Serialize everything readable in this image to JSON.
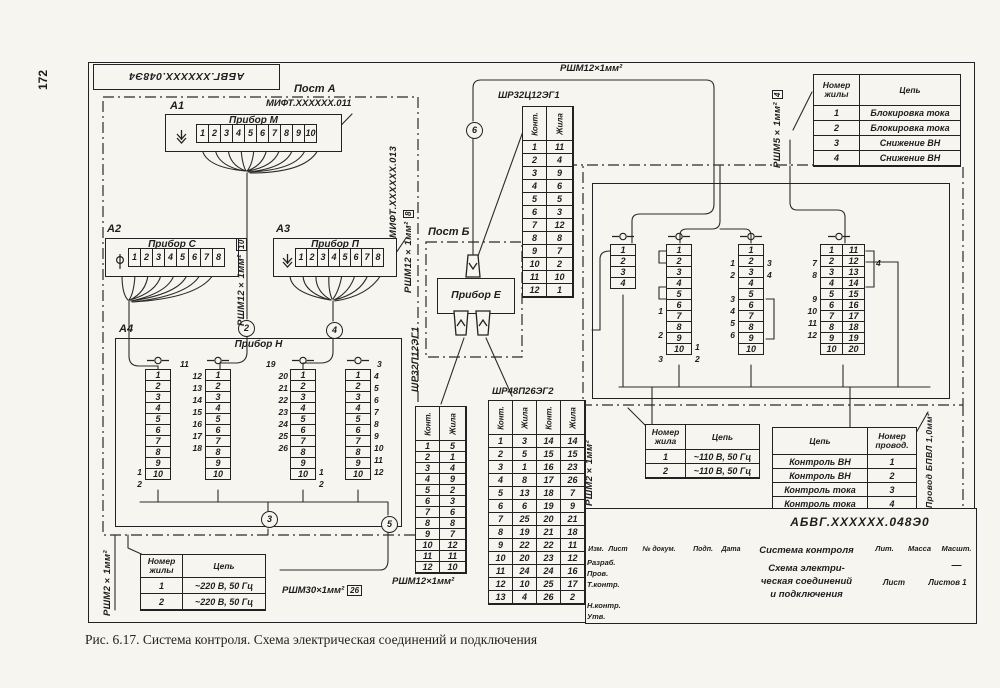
{
  "page": {
    "number": "172",
    "caption": "Рис. 6.17. Система контроля. Схема электрическая соединений и подключения"
  },
  "corner_stamp": "АБВГ.ХХХХХХ.048Э4",
  "posts": {
    "a": "Пост А",
    "b": "Пост Б"
  },
  "devices": {
    "a1": {
      "ref": "А1",
      "title": "Прибор М",
      "doc": "МИФТ.ХХХХХХ.011",
      "terminals": [
        "1",
        "2",
        "3",
        "4",
        "5",
        "6",
        "7",
        "8",
        "9",
        "10"
      ]
    },
    "a2": {
      "ref": "А2",
      "title": "Прибор С",
      "terminals": [
        "1",
        "2",
        "3",
        "4",
        "5",
        "6",
        "7",
        "8"
      ]
    },
    "a3": {
      "ref": "А3",
      "title": "Прибор П",
      "terminals": [
        "1",
        "2",
        "3",
        "4",
        "5",
        "6",
        "7",
        "8"
      ]
    },
    "a4": {
      "ref": "А4",
      "title": "Прибор Н",
      "s1": {
        "cells": [
          "1",
          "2",
          "3",
          "4",
          "5",
          "6",
          "7",
          "8",
          "9",
          "10"
        ],
        "left": [
          "",
          "",
          "",
          "",
          "",
          "",
          "",
          "",
          "1",
          "2"
        ]
      },
      "s2": {
        "head": "11",
        "cells": [
          "1",
          "2",
          "3",
          "4",
          "5",
          "6",
          "7",
          "8",
          "9",
          "10"
        ],
        "left": [
          "12",
          "13",
          "14",
          "15",
          "16",
          "17",
          "18",
          "",
          "",
          ""
        ]
      },
      "s3": {
        "head": "19",
        "cells": [
          "1",
          "2",
          "3",
          "4",
          "5",
          "6",
          "7",
          "8",
          "9",
          "10"
        ],
        "left": [
          "20",
          "21",
          "22",
          "23",
          "24",
          "25",
          "26",
          "",
          "",
          ""
        ],
        "right": [
          "",
          "",
          "",
          "",
          "",
          "",
          "",
          "",
          "1",
          "2"
        ]
      },
      "s4": {
        "head": "3",
        "cells": [
          "1",
          "2",
          "3",
          "4",
          "5",
          "6",
          "7",
          "8",
          "9",
          "10"
        ],
        "right": [
          "4",
          "5",
          "6",
          "7",
          "8",
          "9",
          "10",
          "11",
          "12",
          ""
        ]
      }
    },
    "e": {
      "title": "Прибор Е"
    }
  },
  "right_unit": {
    "r1": {
      "cells": [
        "1",
        "2",
        "3",
        "4"
      ]
    },
    "r2": {
      "cells": [
        "1",
        "2",
        "3",
        "4",
        "5",
        "6",
        "7",
        "8",
        "9",
        "10"
      ],
      "left": [
        "",
        "",
        "",
        "",
        "",
        "1",
        "",
        "2",
        "",
        "3"
      ],
      "right": [
        "",
        "",
        "",
        "",
        "",
        "",
        "",
        "",
        "1",
        "2"
      ]
    },
    "r3": {
      "cells": [
        "1",
        "2",
        "3",
        "4",
        "5",
        "6",
        "7",
        "8",
        "9",
        "10"
      ],
      "left": [
        "",
        "1",
        "2",
        "",
        "3",
        "4",
        "5",
        "6",
        "",
        ""
      ],
      "right": [
        "",
        "3",
        "4",
        "",
        "",
        "",
        "",
        "",
        "",
        ""
      ]
    },
    "r4": {
      "cells_left": [
        "1",
        "2",
        "3",
        "4",
        "5",
        "6",
        "7",
        "8",
        "9",
        "10"
      ],
      "cells_right": [
        "11",
        "12",
        "13",
        "14",
        "15",
        "16",
        "17",
        "18",
        "19",
        "20"
      ],
      "left": [
        "",
        "7",
        "8",
        "",
        "9",
        "10",
        "11",
        "12",
        "",
        ""
      ],
      "right": [
        "",
        "4",
        "",
        "",
        "",
        "",
        "",
        "",
        "",
        ""
      ]
    }
  },
  "junctions": {
    "j2": "2",
    "j3": "3",
    "j4": "4",
    "j5": "5",
    "j6": "6"
  },
  "cable_labels": {
    "top": "РШМ12×1мм²",
    "rsh12_10": {
      "text": "РШМ12×1мм²",
      "qty": "10"
    },
    "mift013": "МИФТ.ХХХХХХ.013",
    "rsh12_8": {
      "text": "РШМ12×1мм²",
      "qty": "8"
    },
    "shr32p": "ШР32П12ЭГ1",
    "rsh5_4": {
      "text": "РШМ5×1мм²",
      "qty": "4"
    },
    "rsh2_right": "РШМ2×1мм²",
    "bpvl": "Провод БПВЛ 1,0мм²",
    "rsh2_left": "РШМ2×1мм²",
    "rsh30_26": {
      "text": "РШМ30×1мм²",
      "qty": "26"
    },
    "rsh12_bottom": "РШМ12×1мм²"
  },
  "conn_tables": {
    "shr32": {
      "title": "ШР32Ц12ЭГ1",
      "headers": [
        "Конт.",
        "Жила"
      ],
      "rows": [
        [
          "1",
          "11"
        ],
        [
          "2",
          "4"
        ],
        [
          "3",
          "9"
        ],
        [
          "4",
          "6"
        ],
        [
          "5",
          "5"
        ],
        [
          "6",
          "3"
        ],
        [
          "7",
          "12"
        ],
        [
          "8",
          "8"
        ],
        [
          "9",
          "7"
        ],
        [
          "10",
          "2"
        ],
        [
          "11",
          "10"
        ],
        [
          "12",
          "1"
        ]
      ]
    },
    "left12": {
      "headers": [
        "Конт.",
        "Жила"
      ],
      "rows": [
        [
          "1",
          "5"
        ],
        [
          "2",
          "1"
        ],
        [
          "3",
          "4"
        ],
        [
          "4",
          "9"
        ],
        [
          "5",
          "2"
        ],
        [
          "6",
          "3"
        ],
        [
          "7",
          "6"
        ],
        [
          "8",
          "8"
        ],
        [
          "9",
          "7"
        ],
        [
          "10",
          "12"
        ],
        [
          "11",
          "11"
        ],
        [
          "12",
          "10"
        ]
      ]
    },
    "shr48": {
      "title": "ШР48П26ЭГ2",
      "headers": [
        "Конт.",
        "Жила",
        "Конт.",
        "Жила"
      ],
      "rows": [
        [
          "1",
          "3",
          "14",
          "14"
        ],
        [
          "2",
          "5",
          "15",
          "15"
        ],
        [
          "3",
          "1",
          "16",
          "23"
        ],
        [
          "4",
          "8",
          "17",
          "26"
        ],
        [
          "5",
          "13",
          "18",
          "7"
        ],
        [
          "6",
          "6",
          "19",
          "9"
        ],
        [
          "7",
          "25",
          "20",
          "21"
        ],
        [
          "8",
          "19",
          "21",
          "18"
        ],
        [
          "9",
          "22",
          "22",
          "11"
        ],
        [
          "10",
          "20",
          "23",
          "12"
        ],
        [
          "11",
          "24",
          "24",
          "16"
        ],
        [
          "12",
          "10",
          "25",
          "17"
        ],
        [
          "13",
          "4",
          "26",
          "2"
        ]
      ]
    }
  },
  "info_tables": {
    "blocking": {
      "headers": [
        "Номер жилы",
        "Цепь"
      ],
      "rows": [
        [
          "1",
          "Блокировка тока"
        ],
        [
          "2",
          "Блокировка тока"
        ],
        [
          "3",
          "Снижение ВН"
        ],
        [
          "4",
          "Снижение ВН"
        ]
      ]
    },
    "v110": {
      "headers": [
        "Номер жила",
        "Цепь"
      ],
      "rows": [
        [
          "1",
          "~110 В, 50 Гц"
        ],
        [
          "2",
          "~110 В, 50 Гц"
        ]
      ]
    },
    "control": {
      "headers": [
        "Цепь",
        "Номер провод."
      ],
      "rows": [
        [
          "Контроль ВН",
          "1"
        ],
        [
          "Контроль ВН",
          "2"
        ],
        [
          "Контроль тока",
          "3"
        ],
        [
          "Контроль тока",
          "4"
        ]
      ]
    },
    "v220": {
      "headers": [
        "Номер жилы",
        "Цепь"
      ],
      "rows": [
        [
          "1",
          "~220 В, 50 Гц"
        ],
        [
          "2",
          "~220 В, 50 Гц"
        ]
      ]
    }
  },
  "title_block": {
    "doc_number": "АБВГ.ХХХХХХ.048Э0",
    "system": "Система контроля",
    "scheme_l1": "Схема электри-",
    "scheme_l2": "ческая соединений",
    "scheme_l3": "и подключения",
    "cols": {
      "izm": "Изм.",
      "list": "Лист",
      "doc": "№ докум.",
      "podp": "Подп.",
      "date": "Дата"
    },
    "roles": {
      "r1": "Разраб.",
      "r2": "Пров.",
      "r3": "Т.контр.",
      "r4": "Н.контр.",
      "r5": "Утв."
    },
    "lit": "Лит.",
    "mass": "Масса",
    "scale_h": "Масшт.",
    "scale": "—",
    "sheet": "Лист",
    "sheets": "Листов 1"
  }
}
